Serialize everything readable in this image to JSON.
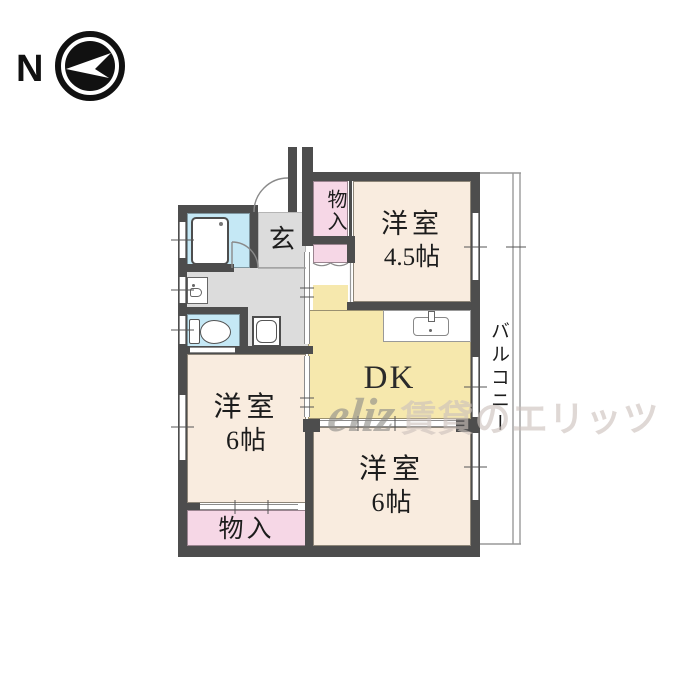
{
  "compass": {
    "label": "N"
  },
  "rooms": {
    "closet_top": {
      "label": "物入"
    },
    "western45": {
      "label": "洋室",
      "size": "4.5帖"
    },
    "entrance": {
      "label": "玄"
    },
    "dk": {
      "label": "DK"
    },
    "western6_left": {
      "label": "洋室",
      "size": "6帖"
    },
    "western6_bottom": {
      "label": "洋室",
      "size": "6帖"
    },
    "closet_bottom": {
      "label": "物入"
    },
    "balcony": {
      "label": "バルコニー"
    }
  },
  "watermark": {
    "logo": "eliz",
    "text": "賃貸のエリッツ"
  },
  "colors": {
    "wall": "#4d4d4d",
    "roomCream": "#f9ecdf",
    "dkYellow": "#f6e8ad",
    "closetPink": "#f6d7e6",
    "waterCyan": "#c5e8f5",
    "floorGray": "#dcdcdc",
    "wmLogo": "#8e8d89",
    "wmText": "#ccc1bc"
  }
}
